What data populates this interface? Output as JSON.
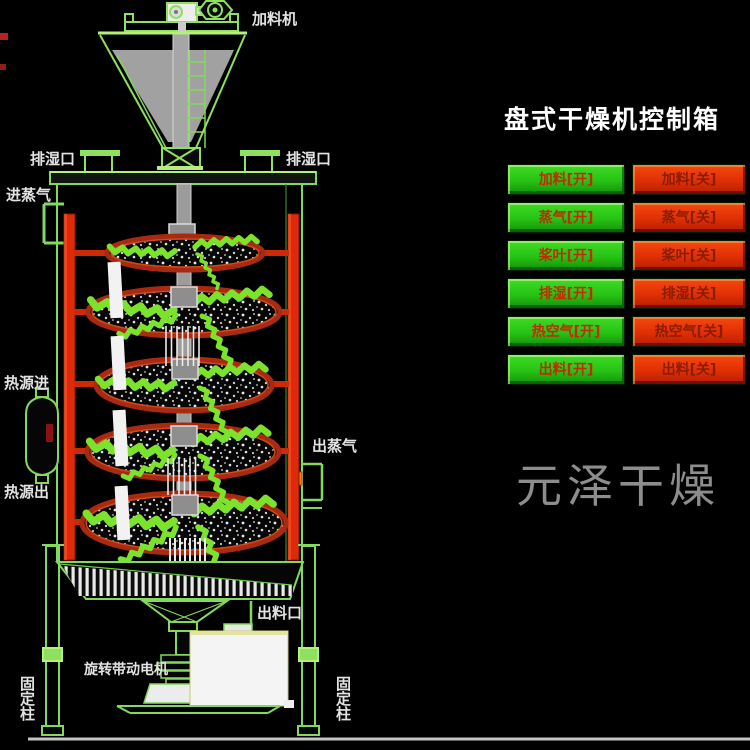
{
  "diagram": {
    "labels": {
      "feeder": "加料机",
      "moist_left": "排湿口",
      "moist_right": "排湿口",
      "steam_in": "进蒸气",
      "heat_in": "热源进",
      "heat_out": "热源出",
      "steam_out": "出蒸气",
      "discharge": "出料口",
      "motor": "旋转带动电机",
      "post_left": "固定柱",
      "post_right": "固定柱"
    }
  },
  "panel": {
    "title": "盘式干燥机控制箱",
    "buttons": [
      {
        "on": "加料[开]",
        "off": "加料[关]"
      },
      {
        "on": "蒸气[开]",
        "off": "蒸气[关]"
      },
      {
        "on": "桨叶[开]",
        "off": "桨叶[关]"
      },
      {
        "on": "排湿[开]",
        "off": "排湿[关]"
      },
      {
        "on": "热空气[开]",
        "off": "热空气[关]"
      },
      {
        "on": "出料[开]",
        "off": "出料[关]"
      }
    ]
  },
  "watermark": "元泽干燥",
  "colors": {
    "button_on": "#27c315",
    "button_off": "#e02f05",
    "line_green": "#82d95b",
    "column_red": "#dd2a0a",
    "title_text": "#ffffff",
    "watermark_text": "#8d8d8d"
  }
}
